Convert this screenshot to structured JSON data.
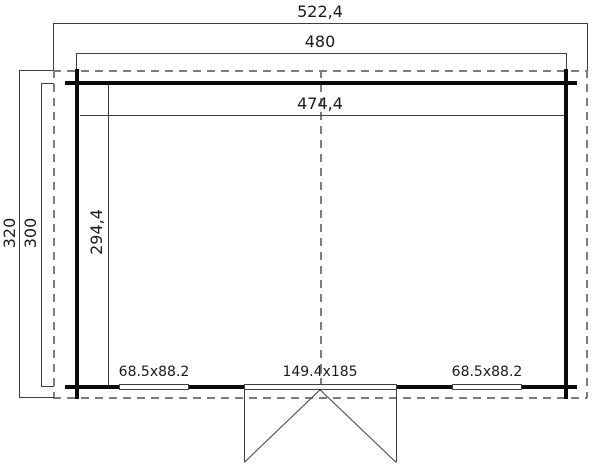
{
  "plan": {
    "dimensions": {
      "overall_width": "522,4",
      "frame_width": "480",
      "inner_width": "474,4",
      "overall_depth": "320",
      "frame_depth": "300",
      "inner_depth": "294,4"
    },
    "openings": {
      "left_window": "68.5x88.2",
      "door": "149.4x185",
      "right_window": "68.5x88.2"
    }
  },
  "colors": {
    "wall": "#0a0a0a",
    "line": "#3e3e3e",
    "dash": "#7d7d7d",
    "text": "#1a1a1a",
    "background": "#ffffff"
  }
}
